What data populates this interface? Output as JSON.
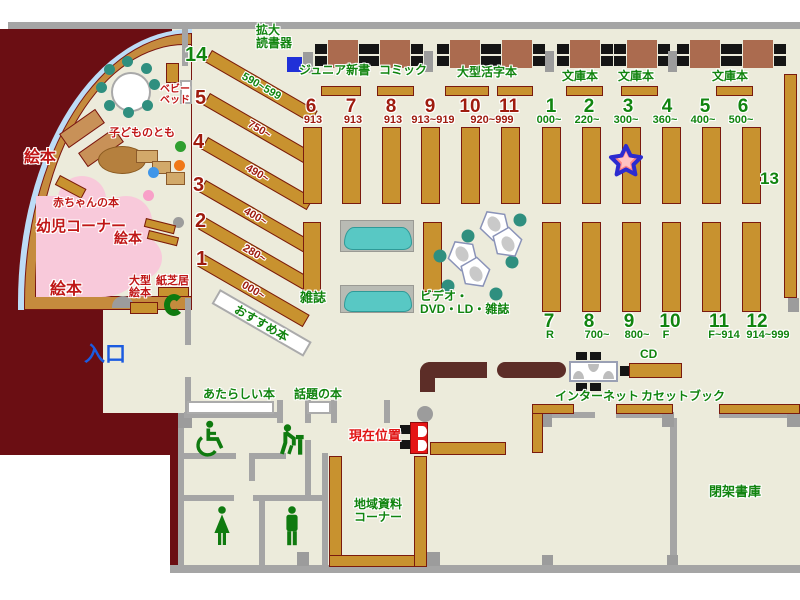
{
  "labels": {
    "magnifier": "拡大\n読書器",
    "entrance": "入口",
    "recommended": "おすすめ本",
    "magazines": "雑誌",
    "av_corner": "ビデオ・\nDVD・LD・雑誌",
    "new_books": "あたらしい本",
    "topic_books": "話題の本",
    "current_location": "現在位置",
    "local_materials": "地域資料\nコーナー",
    "internet": "インターネット",
    "cd": "CD",
    "cassette_books": "カセットブック",
    "closed_stacks": "閉架書庫",
    "stack13": "13"
  },
  "genre_labels": {
    "junior": "ジュニア新書",
    "comic": "コミック",
    "large_print": "大型活字本",
    "bunko": "文庫本"
  },
  "children": {
    "ehon": "絵本",
    "baby_books": "赤ちゃんの本",
    "infant_corner": "幼児コーナー",
    "kodomo_no_tomo": "子どものとも",
    "baby_bed": "ベビー\nベッド",
    "large_picture_books": "大型\n絵本",
    "kamishibai": "紙芝居"
  },
  "nonfiction_stacks": [
    {
      "no": "14",
      "range": "590~599"
    },
    {
      "no": "5",
      "range": "750~"
    },
    {
      "no": "4",
      "range": "490~"
    },
    {
      "no": "3",
      "range": "400~"
    },
    {
      "no": "2",
      "range": "280~"
    },
    {
      "no": "1",
      "range": "000~"
    }
  ],
  "fiction_stacks": {
    "numbers": [
      "6",
      "7",
      "8",
      "9",
      "10",
      "11"
    ],
    "ranges": [
      "913",
      "913",
      "913",
      "913~919"
    ],
    "shared_range": "920~999"
  },
  "green_stacks_top": [
    {
      "no": "1",
      "range": "000~"
    },
    {
      "no": "2",
      "range": "220~"
    },
    {
      "no": "3",
      "range": "300~"
    },
    {
      "no": "4",
      "range": "360~"
    },
    {
      "no": "5",
      "range": "400~"
    },
    {
      "no": "6",
      "range": "500~"
    }
  ],
  "green_stacks_bottom": [
    {
      "no": "7",
      "range": "R"
    },
    {
      "no": "8",
      "range": "700~"
    },
    {
      "no": "9",
      "range": "800~"
    },
    {
      "no": "10",
      "range": "F"
    },
    {
      "no": "11",
      "range": "F~914"
    },
    {
      "no": "12",
      "range": "914~999"
    }
  ],
  "colors": {
    "floor": "#ECEBDB",
    "outside": "#6B0E13",
    "shelf": "#C8922F",
    "green_text": "#11840F",
    "brick_text": "#9E1B0E",
    "label_red": "#C01717",
    "entrance_blue": "#1B5BE0",
    "kiosk_red": "#E51515",
    "pink_area": "#F8C9DA",
    "rack_cyan": "#58C8C4",
    "star_fill": "#FF8585",
    "star_border": "#2B2BD0"
  }
}
